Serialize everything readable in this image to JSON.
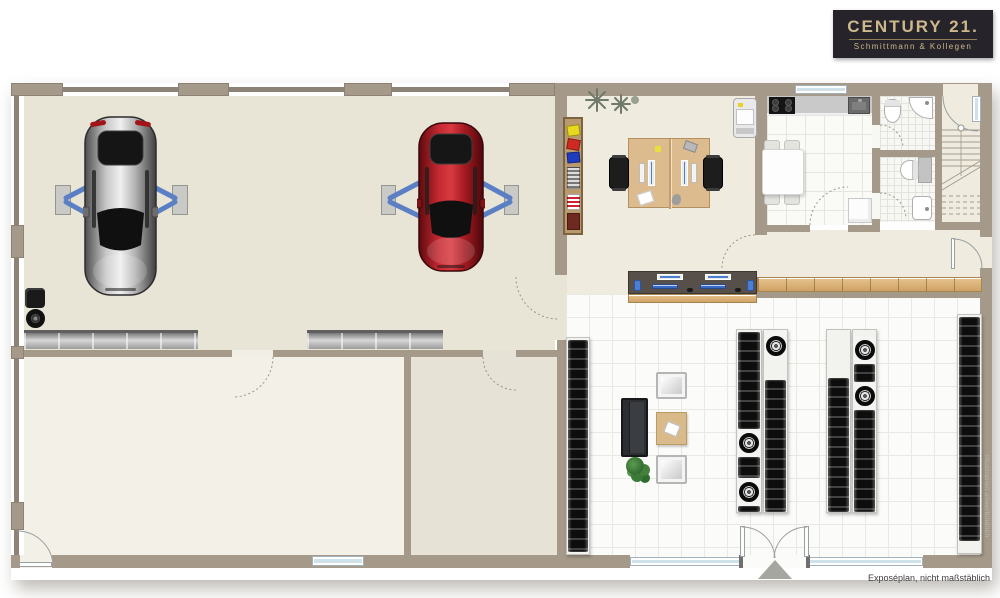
{
  "branding": {
    "logo_title": "CENTURY 21.",
    "logo_subtitle": "Schmittmann & Kollegen",
    "logo_bg": "#26242a",
    "logo_gold": "#cdb88c"
  },
  "watermark": {
    "text": "CENTURY 21"
  },
  "footer": {
    "caption": "Exposéplan, nicht maßstäblich",
    "side_credit": "Illustration unverbindlich"
  },
  "colors": {
    "wall": "#a59a89",
    "wall_line": "#8d8276",
    "workshop_floor": "#e8e4d6",
    "storage_room_floor": "#f3f0e7",
    "side_room_floor": "#e6e2d5",
    "office_floor": "#efecdf",
    "tile_floor": "#fbfbf9",
    "lift_arm_blue": "#5b7fc4",
    "car_silver": "#c9c9c9",
    "car_red": "#c32730",
    "wood": "#d9b57e",
    "counter_dark": "#57504a",
    "tire_black": "#0d0d0d"
  },
  "floorplan": {
    "type": "car-workshop-with-tire-sales-floorplan",
    "rooms": [
      "workshop",
      "storage-room",
      "side-room",
      "office",
      "kitchen",
      "wc-1",
      "wc-2",
      "staircase-hall",
      "corridor",
      "tire-sales-area"
    ],
    "furniture": [
      "silver-car-on-lift",
      "red-car-on-lift",
      "workbench",
      "tool-cart",
      "double-desk-with-monitors",
      "office-chairs",
      "folder-shelf",
      "printer",
      "kitchen-counter-with-cooktop-and-sink",
      "dining-table-with-chairs",
      "toilets",
      "washbasins",
      "staircase",
      "reception-counter",
      "sideboard",
      "tire-racks",
      "wheel-rims",
      "sofa",
      "armchairs",
      "coffee-table",
      "plant",
      "entrance-arrow"
    ]
  }
}
